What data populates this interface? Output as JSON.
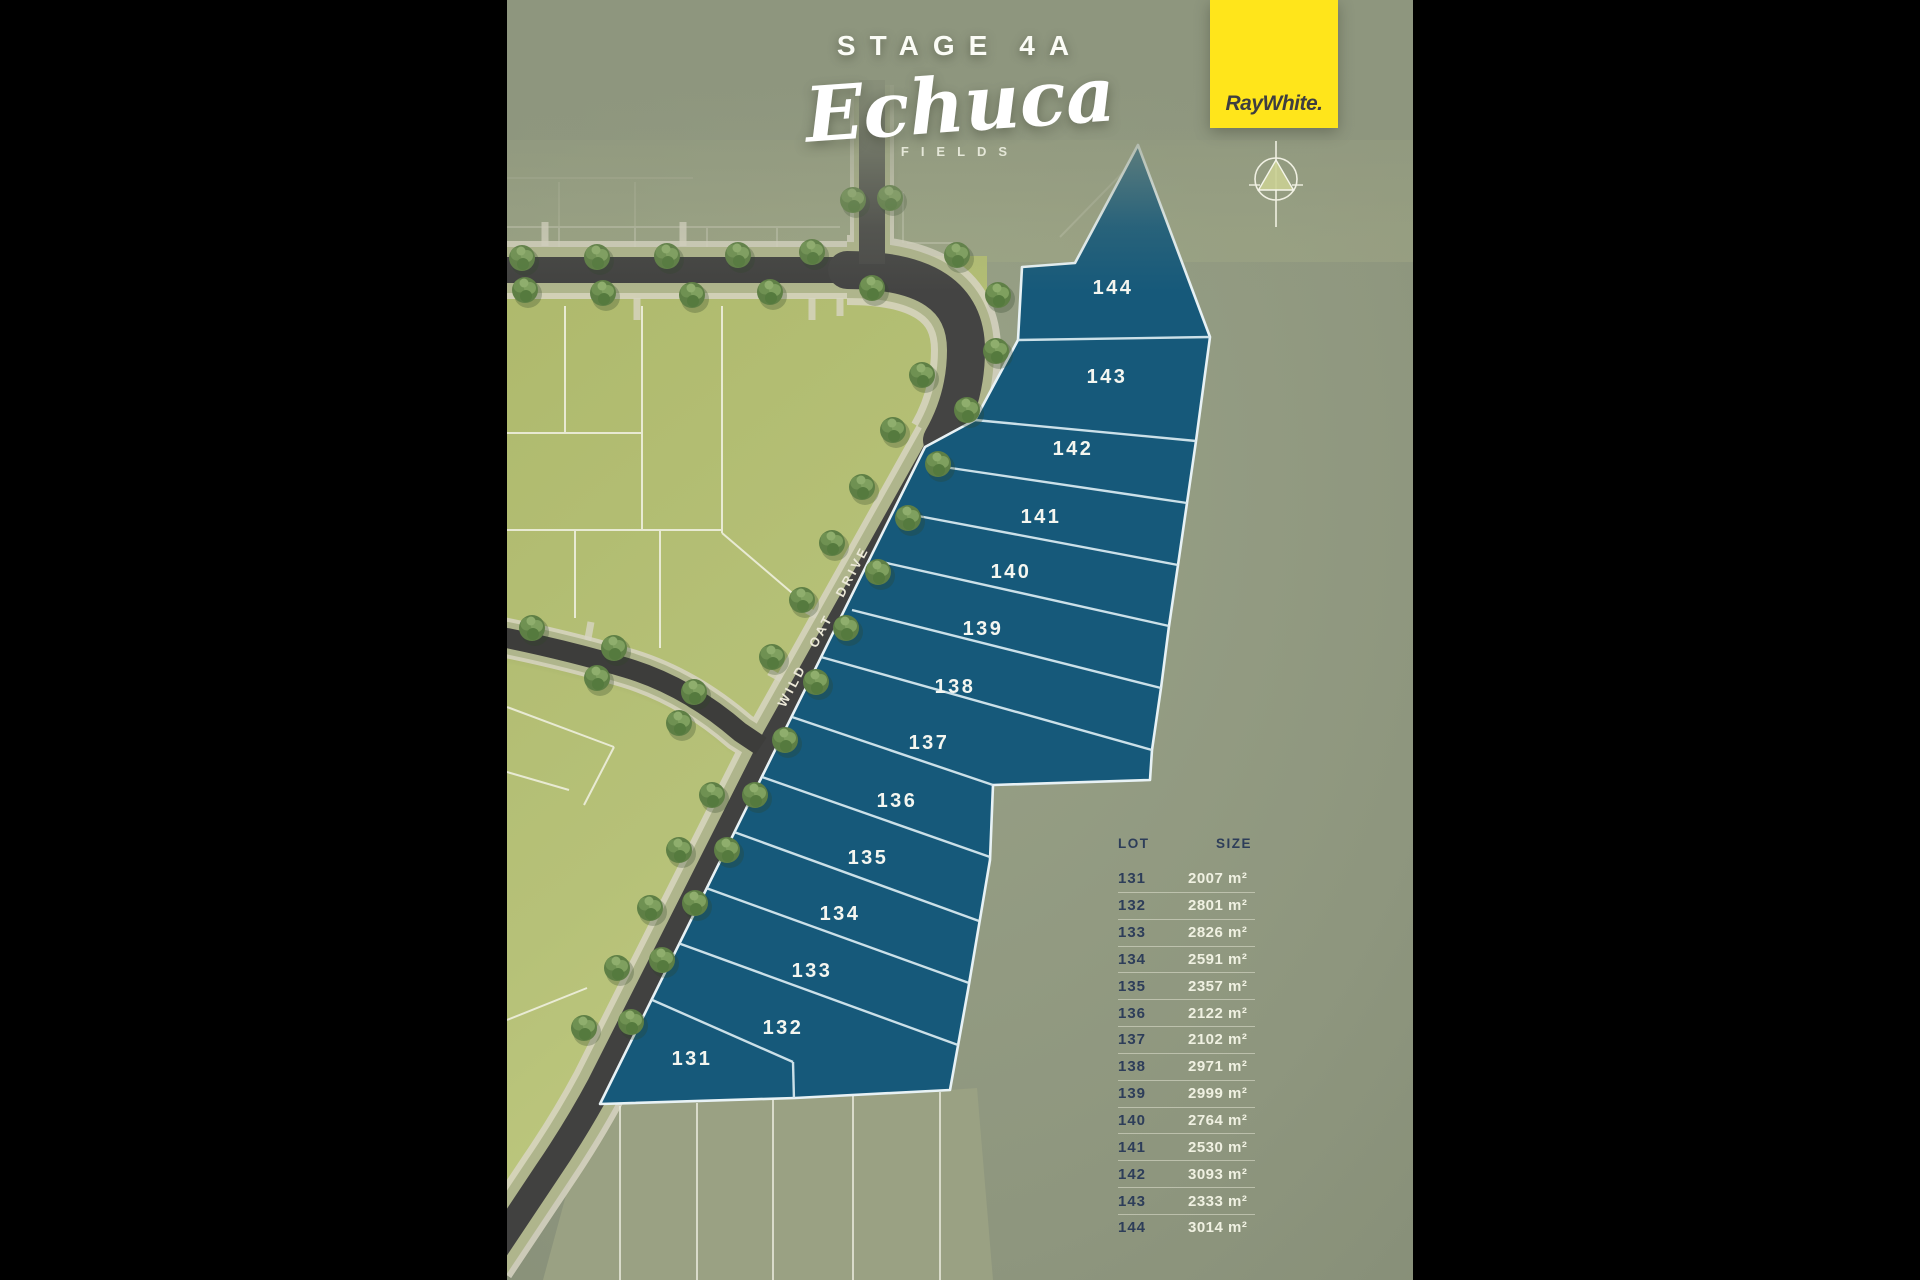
{
  "title": {
    "stage_label": "STAGE",
    "stage_number": "4A",
    "estate_name": "Echuca",
    "estate_subtitle": "FIELDS"
  },
  "brand": {
    "logo_text": "RayWhite."
  },
  "map": {
    "road_name": "WILD OAT DRIVE"
  },
  "legend": {
    "lot_header": "LOT",
    "size_header": "SIZE"
  },
  "lots": [
    {
      "id": "131",
      "size": "2007 m²"
    },
    {
      "id": "132",
      "size": "2801 m²"
    },
    {
      "id": "133",
      "size": "2826 m²"
    },
    {
      "id": "134",
      "size": "2591 m²"
    },
    {
      "id": "135",
      "size": "2357 m²"
    },
    {
      "id": "136",
      "size": "2122 m²"
    },
    {
      "id": "137",
      "size": "2102 m²"
    },
    {
      "id": "138",
      "size": "2971 m²"
    },
    {
      "id": "139",
      "size": "2999 m²"
    },
    {
      "id": "140",
      "size": "2764 m²"
    },
    {
      "id": "141",
      "size": "2530 m²"
    },
    {
      "id": "142",
      "size": "3093 m²"
    },
    {
      "id": "143",
      "size": "2333 m²"
    },
    {
      "id": "144",
      "size": "3014 m²"
    }
  ],
  "colors": {
    "brand_yellow": "#ffe51b",
    "stage_lot_blue": "#16597a",
    "released_lot_olive": "#b5bf75",
    "background_sage": "#8e967e",
    "table_navy": "#2d3d59",
    "road_grey": "#414140",
    "sidewalk_cream": "#d8d5c3"
  }
}
